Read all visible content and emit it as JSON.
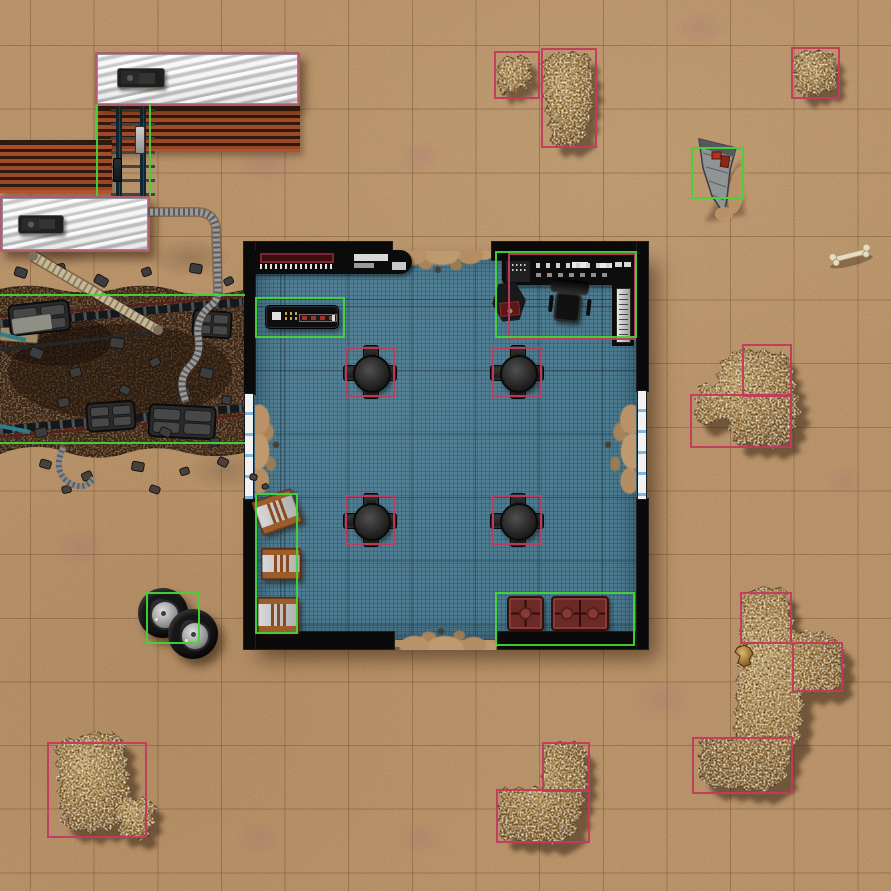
{
  "map": {
    "title": "Desert dig-site tactical battle map (editor view)",
    "grid": {
      "cell_px": 63.64,
      "cols": 14,
      "rows": 14,
      "offset": [
        30,
        46
      ]
    },
    "palette": {
      "sand": "#bb946a",
      "grid_line": "#6a4428",
      "floor_teal": "#4d7b90",
      "wall_black": "#0a0a0a",
      "selection_pink": "#c23a5e",
      "selection_green": "#43d437",
      "rock_light": "#d9b873",
      "rock_dark": "#6f4a1c",
      "trench_soil": "#3b2315",
      "rust_track": "#93492a",
      "train_silver": "#dedede",
      "train_border_pink": "#b25a70",
      "crate_wood": "#9c5c2c",
      "sofa_red": "#6b2a26",
      "window_blue": "#85b7dc"
    },
    "objects": {
      "train_car_north": {
        "type": "rail-car",
        "selected": true,
        "selection_color": "pink",
        "box": [
          95,
          52,
          205,
          54
        ]
      },
      "train_hatch_north": {
        "type": "roof-hatch",
        "box": [
          117,
          68,
          48,
          20
        ]
      },
      "trackbed_north": {
        "type": "track-bed",
        "box": [
          97,
          106,
          203,
          46
        ]
      },
      "trackbed_west": {
        "type": "track-bed",
        "box": [
          0,
          140,
          112,
          53
        ]
      },
      "rails_north": {
        "type": "rails",
        "box": [
          111,
          98,
          44,
          104
        ]
      },
      "rail_coupler_a": {
        "type": "rail-coupler",
        "box": [
          135,
          126,
          10,
          28
        ]
      },
      "rail_coupler_b": {
        "type": "rail-coupler-dark",
        "box": [
          113,
          158,
          9,
          24
        ]
      },
      "sel_green_rails_l": {
        "type": "selection-green-line-v",
        "box": [
          96,
          104,
          2,
          92
        ]
      },
      "sel_green_rails_r": {
        "type": "selection-green-line-v",
        "box": [
          149,
          104,
          2,
          92
        ]
      },
      "train_car_west": {
        "type": "rail-car",
        "selected": true,
        "selection_color": "pink",
        "box": [
          0,
          196,
          150,
          56
        ]
      },
      "train_hatch_west": {
        "type": "roof-hatch",
        "box": [
          18,
          215,
          46,
          19
        ]
      },
      "sel_green_trench_top": {
        "type": "selection-green-line-h",
        "box": [
          0,
          294,
          245,
          2
        ]
      },
      "sel_green_trench_bottom": {
        "type": "selection-green-line-h",
        "box": [
          0,
          442,
          245,
          2
        ]
      },
      "building_shadow": {
        "type": "shadow",
        "box": [
          249,
          251,
          398,
          396
        ]
      },
      "floor": {
        "type": "bunker-floor",
        "box": [
          253,
          251,
          386,
          389
        ]
      },
      "wall_top_left": {
        "type": "wall",
        "box": [
          243,
          241,
          150,
          20
        ]
      },
      "wall_top_right": {
        "type": "wall",
        "box": [
          491,
          241,
          158,
          20
        ]
      },
      "wall_bottom_left": {
        "type": "wall",
        "box": [
          243,
          631,
          152,
          19
        ]
      },
      "wall_bottom_right": {
        "type": "wall",
        "box": [
          497,
          631,
          152,
          19
        ]
      },
      "wall_left_upper": {
        "type": "wall",
        "box": [
          243,
          241,
          13,
          154
        ]
      },
      "wall_left_lower": {
        "type": "wall",
        "box": [
          243,
          498,
          13,
          152
        ]
      },
      "wall_right_upper": {
        "type": "wall",
        "box": [
          636,
          241,
          13,
          151
        ]
      },
      "wall_right_lower": {
        "type": "wall",
        "box": [
          636,
          498,
          13,
          152
        ]
      },
      "window_left": {
        "type": "window-strip",
        "box": [
          244,
          393,
          10,
          107
        ]
      },
      "window_right": {
        "type": "window-strip",
        "box": [
          637,
          390,
          10,
          110
        ]
      },
      "spill_top": {
        "type": "sand-spill",
        "box": [
          392,
          251,
          100,
          26
        ]
      },
      "spill_bottom": {
        "type": "sand-spill",
        "box": [
          394,
          624,
          102,
          26
        ]
      },
      "spill_left": {
        "type": "sand-spill",
        "box": [
          255,
          396,
          30,
          106
        ]
      },
      "spill_right": {
        "type": "sand-spill",
        "box": [
          596,
          396,
          40,
          106
        ]
      },
      "console_strip": {
        "type": "wall-console",
        "box": [
          252,
          250,
          160,
          24
        ]
      },
      "counter": {
        "type": "console-table",
        "box": [
          265,
          305,
          74,
          24
        ]
      },
      "sel_green_counter": {
        "type": "selection-green",
        "box": [
          255,
          297,
          90,
          41
        ]
      },
      "console_desk": {
        "type": "control-desk",
        "box": [
          502,
          258,
          132,
          27
        ]
      },
      "console_wing": {
        "type": "control-desk-wing",
        "box": [
          612,
          258,
          22,
          88
        ]
      },
      "silver_panel": {
        "type": "server-panel",
        "box": [
          616,
          288,
          15,
          55
        ]
      },
      "hex_machine": {
        "type": "machine",
        "box": [
          492,
          283,
          34,
          38,
          -6
        ]
      },
      "office_chair": {
        "type": "office-chair",
        "box": [
          548,
          280,
          44,
          48,
          6
        ]
      },
      "sel_pink_console": {
        "type": "selection-pink",
        "box": [
          508,
          253,
          128,
          87
        ]
      },
      "sel_green_console": {
        "type": "selection-green",
        "box": [
          495,
          251,
          142,
          87
        ]
      },
      "table_nw": {
        "type": "table-with-chairs",
        "box": [
          343,
          345,
          54,
          54
        ]
      },
      "table_ne": {
        "type": "table-with-chairs",
        "box": [
          490,
          345,
          54,
          54
        ]
      },
      "table_sw": {
        "type": "table-with-chairs",
        "box": [
          343,
          493,
          54,
          54
        ]
      },
      "table_se": {
        "type": "table-with-chairs",
        "box": [
          490,
          493,
          54,
          54
        ]
      },
      "sel_pink_table_nw": {
        "type": "selection-pink",
        "box": [
          345,
          347,
          50,
          50
        ]
      },
      "sel_pink_table_ne": {
        "type": "selection-pink",
        "box": [
          492,
          347,
          50,
          50
        ]
      },
      "sel_pink_table_sw": {
        "type": "selection-pink",
        "box": [
          345,
          495,
          50,
          50
        ]
      },
      "sel_pink_table_se": {
        "type": "selection-pink",
        "box": [
          492,
          495,
          50,
          50
        ]
      },
      "crate_1": {
        "type": "crate",
        "box": [
          256,
          494,
          42,
          36,
          -20
        ]
      },
      "crate_2": {
        "type": "crate",
        "box": [
          261,
          548,
          40,
          32
        ]
      },
      "crate_3": {
        "type": "crate",
        "box": [
          257,
          597,
          42,
          37
        ]
      },
      "sel_green_crates": {
        "type": "selection-green",
        "box": [
          255,
          493,
          43,
          141
        ]
      },
      "sofa_small": {
        "type": "sofa-single",
        "box": [
          507,
          596,
          37,
          35
        ]
      },
      "sofa_large": {
        "type": "sofa-double",
        "box": [
          551,
          596,
          58,
          35
        ]
      },
      "sel_green_sofas": {
        "type": "selection-green",
        "box": [
          495,
          592,
          140,
          54
        ]
      },
      "tire_1": {
        "type": "tire",
        "box": [
          138,
          588,
          50,
          50
        ]
      },
      "tire_2": {
        "type": "tire",
        "box": [
          168,
          609,
          50,
          50
        ]
      },
      "sel_green_tires": {
        "type": "selection-green",
        "box": [
          146,
          592,
          54,
          52
        ]
      },
      "sel_pink_rock_top_small": {
        "type": "selection-pink",
        "box": [
          494,
          51,
          46,
          48
        ]
      },
      "sel_pink_rock_top_big": {
        "type": "selection-pink",
        "box": [
          541,
          48,
          56,
          100
        ]
      },
      "sel_pink_rock_topright": {
        "type": "selection-pink",
        "box": [
          791,
          47,
          49,
          52
        ]
      },
      "sel_green_wing": {
        "type": "selection-green",
        "box": [
          691,
          147,
          53,
          52
        ]
      },
      "sel_pink_rock_right_a": {
        "type": "selection-pink",
        "box": [
          742,
          344,
          50,
          53
        ]
      },
      "sel_pink_rock_right_b": {
        "type": "selection-pink",
        "box": [
          690,
          394,
          102,
          54
        ]
      },
      "sel_pink_rock_br_a": {
        "type": "selection-pink",
        "box": [
          740,
          592,
          52,
          52
        ]
      },
      "sel_pink_rock_br_b": {
        "type": "selection-pink",
        "box": [
          792,
          642,
          51,
          50
        ]
      },
      "sel_pink_rock_br_c": {
        "type": "selection-pink",
        "box": [
          692,
          737,
          101,
          57
        ]
      },
      "sel_pink_rock_bc_a": {
        "type": "selection-pink",
        "box": [
          542,
          742,
          48,
          50
        ]
      },
      "sel_pink_rock_bc_b": {
        "type": "selection-pink",
        "box": [
          496,
          789,
          94,
          54
        ]
      },
      "sel_pink_rock_bl": {
        "type": "selection-pink",
        "box": [
          47,
          742,
          100,
          96
        ]
      }
    },
    "rock_outcrops": [
      {
        "name": "rock-top-small",
        "bbox": [
          497,
          55,
          37,
          43
        ]
      },
      {
        "name": "rock-top-big",
        "bbox": [
          540,
          52,
          57,
          96
        ]
      },
      {
        "name": "rock-top-right",
        "bbox": [
          792,
          50,
          46,
          49
        ]
      },
      {
        "name": "rock-right",
        "bbox": [
          694,
          348,
          109,
          100
        ]
      },
      {
        "name": "rock-bottom-right",
        "bbox": [
          698,
          586,
          147,
          206
        ]
      },
      {
        "name": "rock-bottom-center",
        "bbox": [
          497,
          741,
          92,
          103
        ]
      },
      {
        "name": "rock-bottom-left",
        "bbox": [
          54,
          731,
          84,
          102
        ]
      },
      {
        "name": "rock-fragment-bl",
        "bbox": [
          114,
          796,
          44,
          44
        ]
      }
    ],
    "misc": [
      {
        "name": "dig-site-trench",
        "bbox": [
          0,
          284,
          246,
          170
        ]
      },
      {
        "name": "crashed-wing-debris",
        "bbox": [
          697,
          136,
          45,
          82
        ]
      },
      {
        "name": "bone",
        "bbox": [
          826,
          243,
          50,
          26
        ]
      },
      {
        "name": "fuel-hose",
        "from": [
          148,
          212
        ],
        "to": [
          186,
          402
        ]
      },
      {
        "name": "ribbed-pipe",
        "from": [
          33,
          256
        ],
        "to": [
          158,
          330
        ]
      }
    ]
  }
}
